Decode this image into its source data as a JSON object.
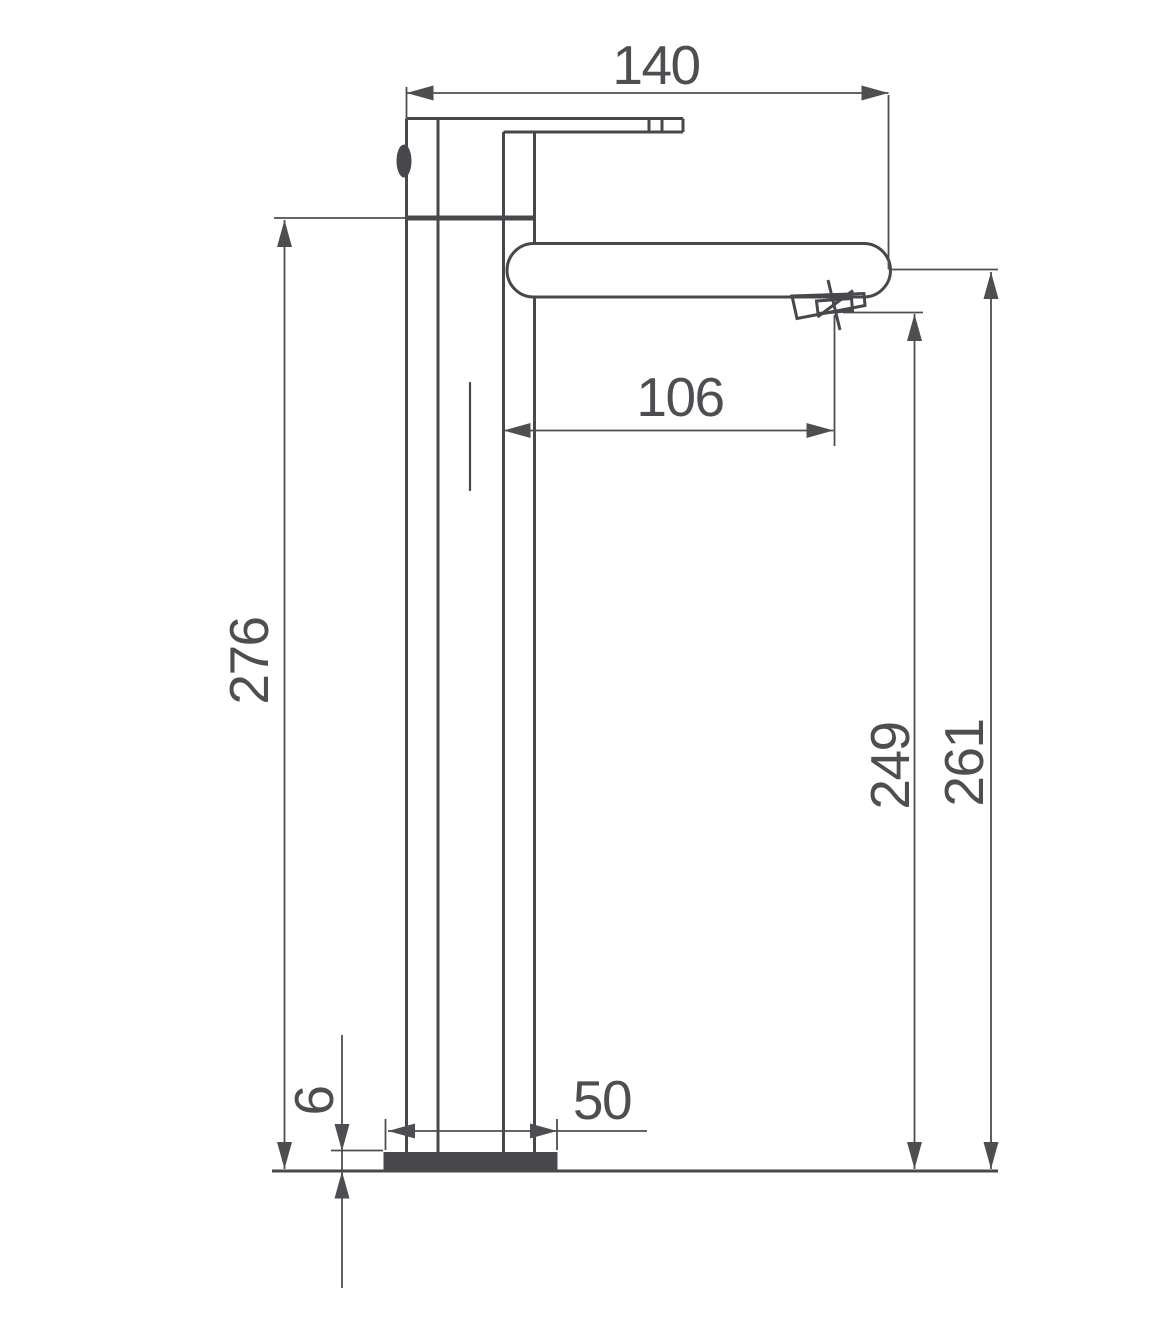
{
  "drawing": {
    "background": "#ffffff",
    "object_line_color": "#48484c",
    "dimension_color": "#4d4d52",
    "dimensions": {
      "total_width": "140",
      "spout_reach": "106",
      "body_height": "276",
      "outlet_height": "249",
      "spout_top_height": "261",
      "base_width": "50",
      "base_plate_thickness": "6"
    }
  }
}
